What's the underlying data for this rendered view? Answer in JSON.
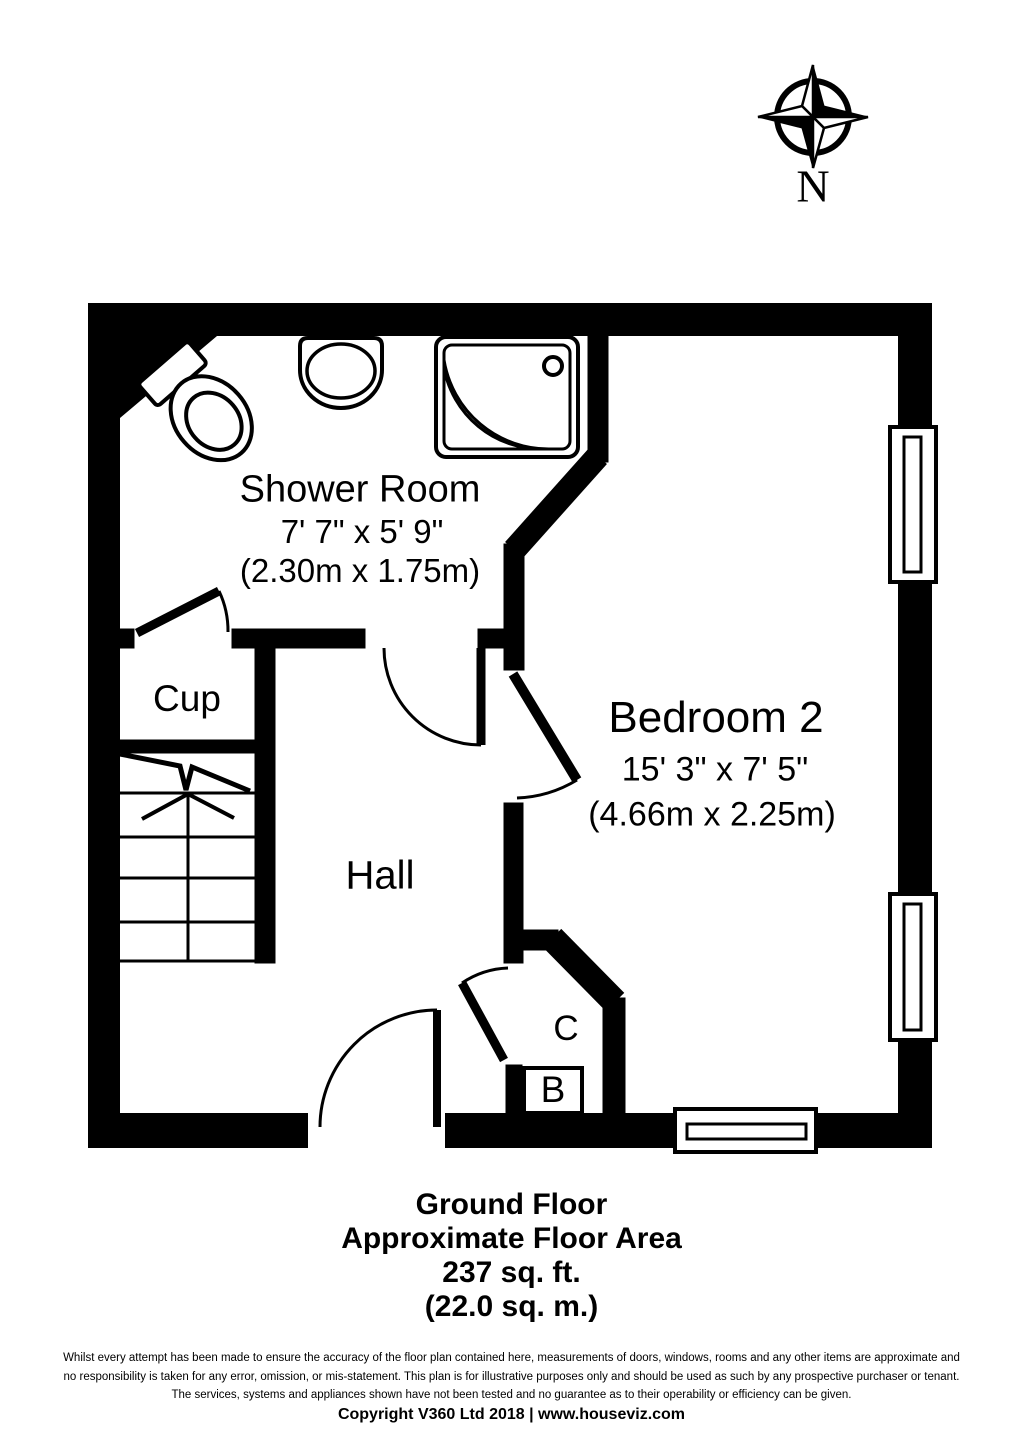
{
  "colors": {
    "wall": "#000000",
    "background": "#ffffff"
  },
  "compass": {
    "label": "N"
  },
  "rooms": {
    "shower_room": {
      "name": "Shower Room",
      "dimensions_imperial": "7' 7\" x 5' 9\"",
      "dimensions_metric": "(2.30m x 1.75m)"
    },
    "bedroom2": {
      "name": "Bedroom 2",
      "dimensions_imperial": "15' 3\" x 7' 5\"",
      "dimensions_metric": "(4.66m x 2.25m)"
    },
    "cupboard": {
      "name": "Cup"
    },
    "hall": {
      "name": "Hall"
    },
    "closet": {
      "name": "C"
    },
    "boiler": {
      "name": "B"
    }
  },
  "summary": {
    "floor": "Ground Floor",
    "area_label": "Approximate Floor Area",
    "area_imperial": "237 sq. ft.",
    "area_metric": "(22.0 sq. m.)"
  },
  "footer": {
    "disclaimer_line1": "Whilst every attempt has been made to ensure the accuracy of the floor plan contained here, measurements of doors, windows, rooms and any other items are approximate and",
    "disclaimer_line2": "no responsibility is taken for any error, omission, or mis-statement. This plan is for illustrative purposes only and should be used as such by any prospective purchaser or tenant.",
    "disclaimer_line3": "The services, systems and appliances shown have not been tested and no guarantee as to their operability or efficiency can be given.",
    "copyright": "Copyright V360 Ltd 2018 | www.houseviz.com"
  }
}
